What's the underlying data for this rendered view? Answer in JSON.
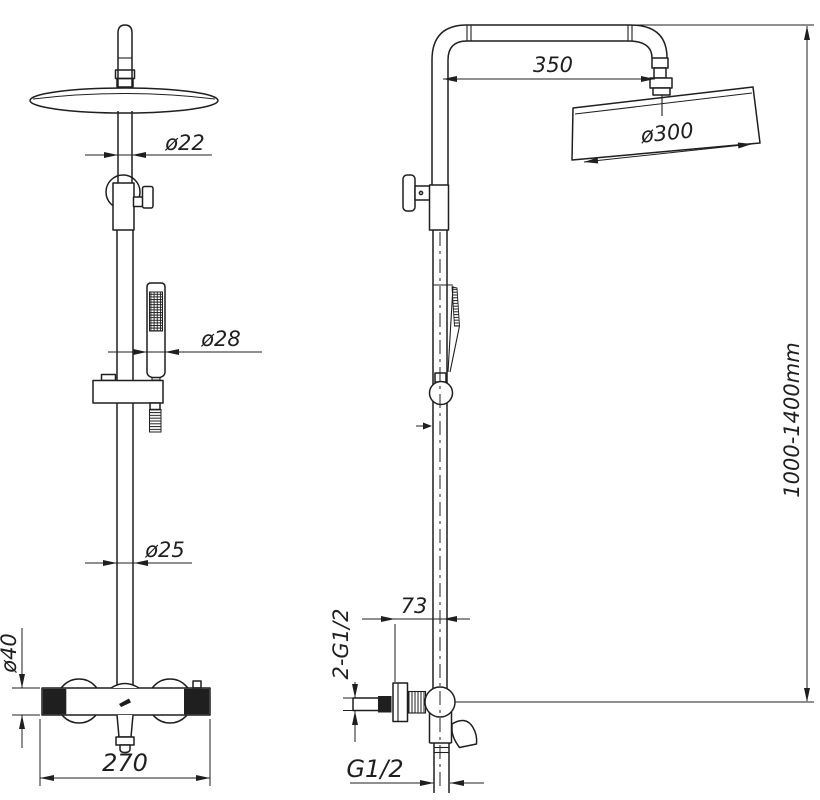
{
  "drawing": {
    "background": "#ffffff",
    "line_color": "#1f1f1f",
    "labels": {
      "front": {
        "top_pipe": "ø22",
        "hand_shower": "ø28",
        "lower_pipe": "ø25",
        "valve_body": "ø40",
        "valve_width": "270"
      },
      "side": {
        "arm_reach": "350",
        "head_diameter": "ø300",
        "height_range": "1000-1400mm",
        "wall_offset": "73",
        "inlet_threads": "2-G1/2",
        "outlet_thread": "G1/2"
      }
    }
  }
}
